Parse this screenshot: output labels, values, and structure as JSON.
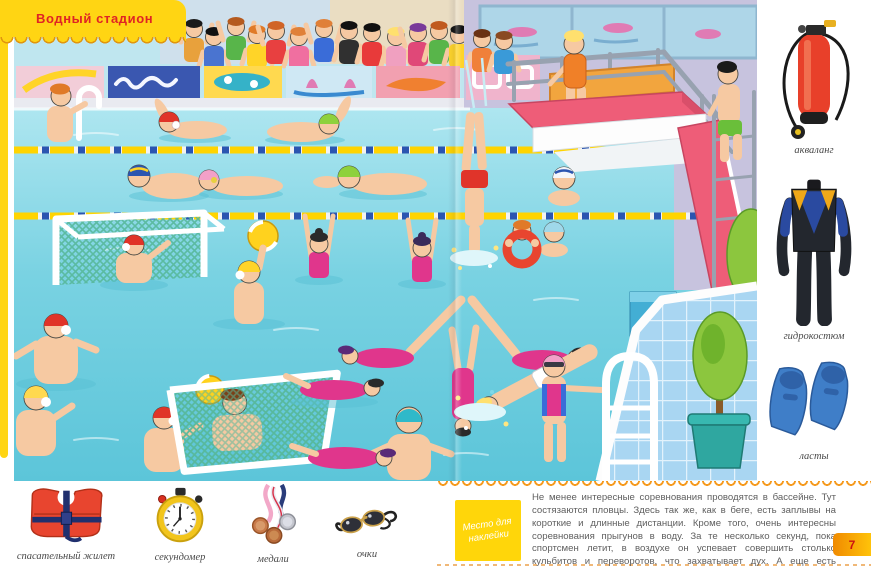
{
  "page": {
    "title": "Водный стадион",
    "page_number": "7"
  },
  "sidebar": {
    "items": [
      {
        "label": "акваланг"
      },
      {
        "label": "гидрокостюм"
      },
      {
        "label": "ласты"
      }
    ]
  },
  "bottom_items": [
    {
      "label": "спасательный жилет"
    },
    {
      "label": "секундомер"
    },
    {
      "label": "медали"
    },
    {
      "label": "очки"
    }
  ],
  "sticker_label": "Место для наклейки",
  "paragraph": "Не менее интересные соревнования проводятся в бассейне. Тут состязаются пловцы. Здесь так же, как в беге, есть заплывы на короткие и длинные дистанции. Кроме того, очень интересны соревнования прыгунов в воду. За те несколько секунд, пока спортсмен летит, в воздухе он успевает совершить столько кульбитов и переворотов, что захватывает дух. А еще есть соревнования по синхронному плаванию и водному поло.",
  "colors": {
    "tab_yellow": "#ffd513",
    "title_red": "#e02424",
    "scallop_orange": "#f59a1e",
    "sticker_yellow": "#ffd60a",
    "water_teal": "#5ec7da",
    "platform_pink": "#ee5d78",
    "page_tab_orange": "#f08a00"
  }
}
